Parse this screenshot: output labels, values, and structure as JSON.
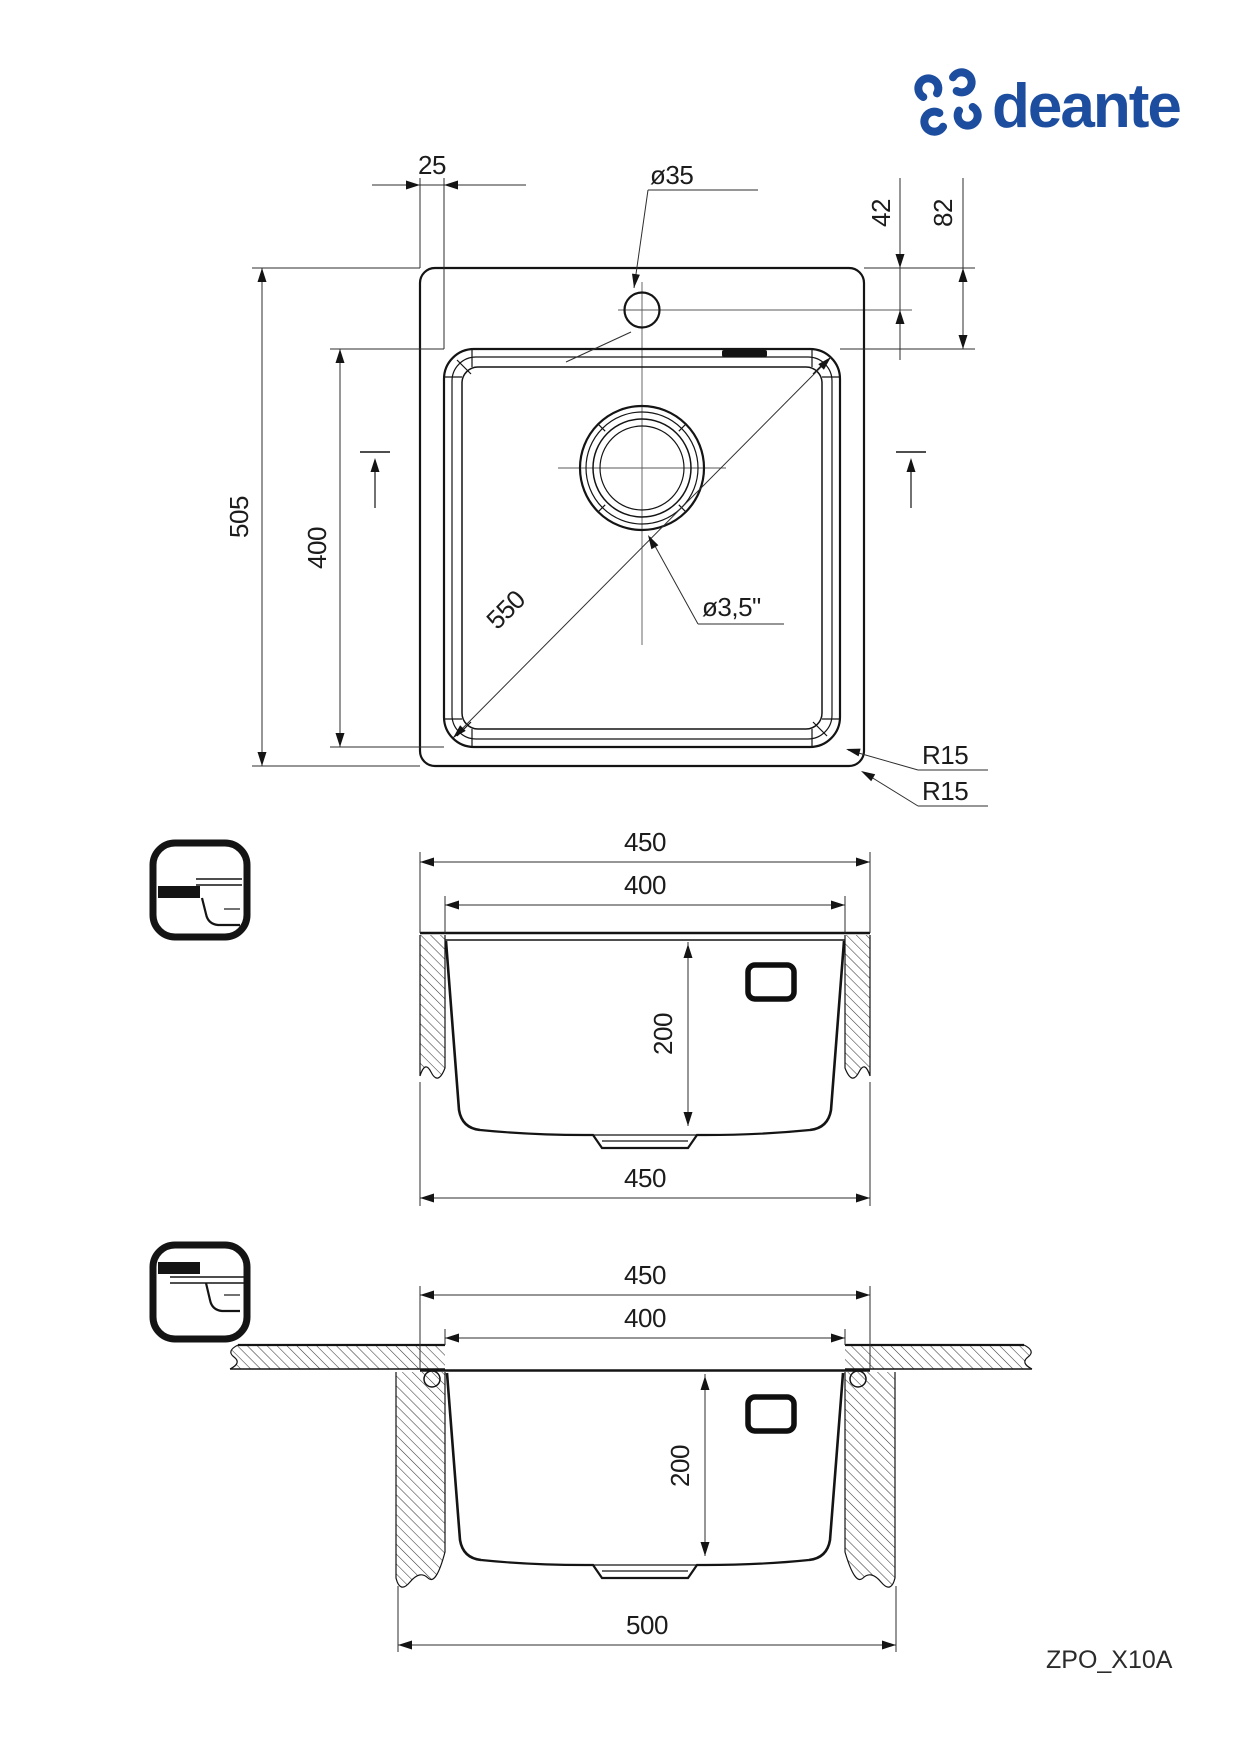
{
  "page": {
    "background": "#ffffff",
    "product_code": "ZPO_X10A"
  },
  "brand": {
    "name": "deante",
    "color": "#1d4d9e"
  },
  "top_view": {
    "dim_edge_to_bowl": "25",
    "dim_faucet_hole_diameter": "ø35",
    "dim_hole_from_edge": "42",
    "dim_bowl_from_edge": "82",
    "dim_overall_depth": "505",
    "dim_bowl_depth": "400",
    "dim_bowl_diagonal": "550",
    "dim_drain_diameter": "ø3,5\"",
    "dim_bowl_corner_radius": "R15",
    "dim_outer_corner_radius": "R15"
  },
  "section_inset": {
    "dim_overall_width": "450",
    "dim_bowl_width": "400",
    "dim_bowl_height": "200",
    "dim_bottom_width": "450"
  },
  "section_undermount": {
    "dim_overall_width": "450",
    "dim_bowl_width": "400",
    "dim_bowl_height": "200",
    "dim_cutout_width": "500"
  }
}
